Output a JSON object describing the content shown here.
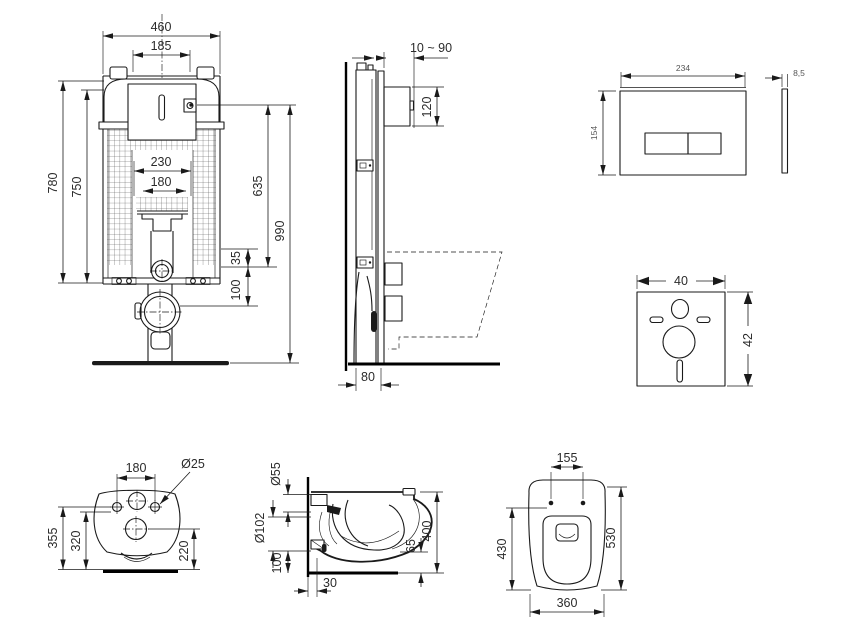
{
  "drawing_title": "Wall-hung WC installation set technical drawing",
  "views": {
    "cistern_front": {
      "name": "Concealed cistern frame - front view",
      "dims": {
        "outer_width": "460",
        "tank_width": "185",
        "inner_width": "230",
        "pipe_width": "180",
        "frame_height": "780",
        "tank_height": "750",
        "right_height": "635",
        "total_height": "990",
        "offset_a": "35",
        "offset_b": "100"
      }
    },
    "cistern_side": {
      "name": "Concealed cistern frame - side view",
      "dims": {
        "wall_finish_range": "10 ~ 90",
        "opening_height": "120",
        "frame_depth": "80"
      }
    },
    "flush_plate": {
      "name": "Flush plate",
      "dims": {
        "width": "234",
        "height": "154",
        "thickness": "8,5"
      }
    },
    "sound_pad": {
      "name": "Sound insulation pad",
      "dims": {
        "width": "40",
        "height": "42"
      }
    },
    "bowl_rear": {
      "name": "WC bowl - rear view",
      "dims": {
        "hole_spacing": "180",
        "hole_diameter": "Ø25",
        "height_total": "355",
        "height_inner": "320",
        "outlet_height": "220"
      }
    },
    "bowl_side": {
      "name": "WC bowl - side view",
      "dims": {
        "inlet_diameter": "Ø55",
        "outlet_diameter": "Ø102",
        "outlet_height": "100",
        "outlet_offset": "30",
        "front_height": "65",
        "total_height": "400"
      }
    },
    "bowl_top": {
      "name": "WC bowl - top view",
      "dims": {
        "hole_spacing": "155",
        "inner_depth": "430",
        "total_depth": "530",
        "width": "360"
      }
    }
  }
}
